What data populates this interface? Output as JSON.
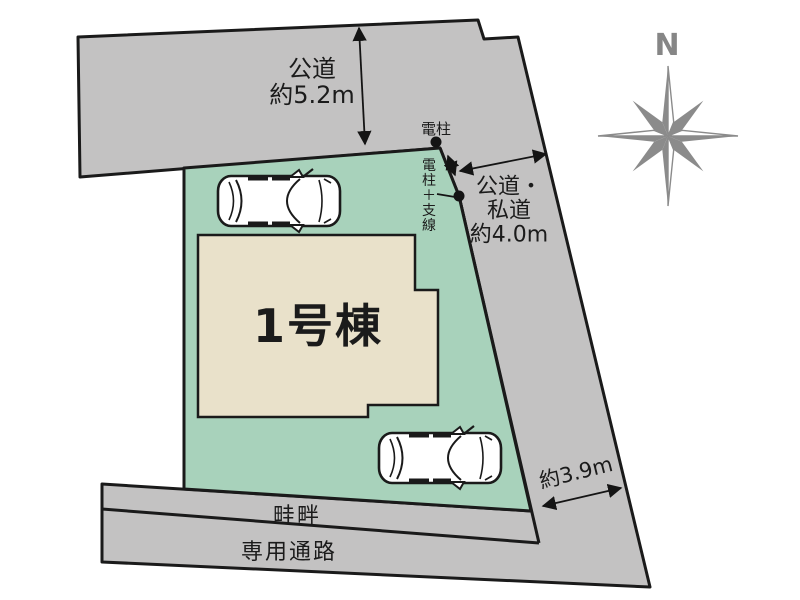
{
  "site_plan": {
    "building": {
      "label": "1号棟"
    },
    "compass": {
      "north_label": "N"
    },
    "dimensions": {
      "top_road": {
        "line1": "公道",
        "line2": "約5.2m"
      },
      "right_road": {
        "line1": "公道・",
        "line2": "私道",
        "line3": "約4.0m"
      },
      "bottom_right": {
        "label": "約3.9m"
      }
    },
    "annotations": {
      "utility_pole": "電柱",
      "utility_pole_wire": "電柱＋支線",
      "ridge": "畦畔",
      "passage": "専用通路"
    },
    "colors": {
      "road": "#c3c2c2",
      "lot": "#a8d2bb",
      "building": "#e9e1ca",
      "outline": "#1a1a1a",
      "compass": "#8b8b8b",
      "compass_light": "#ffffff"
    }
  }
}
